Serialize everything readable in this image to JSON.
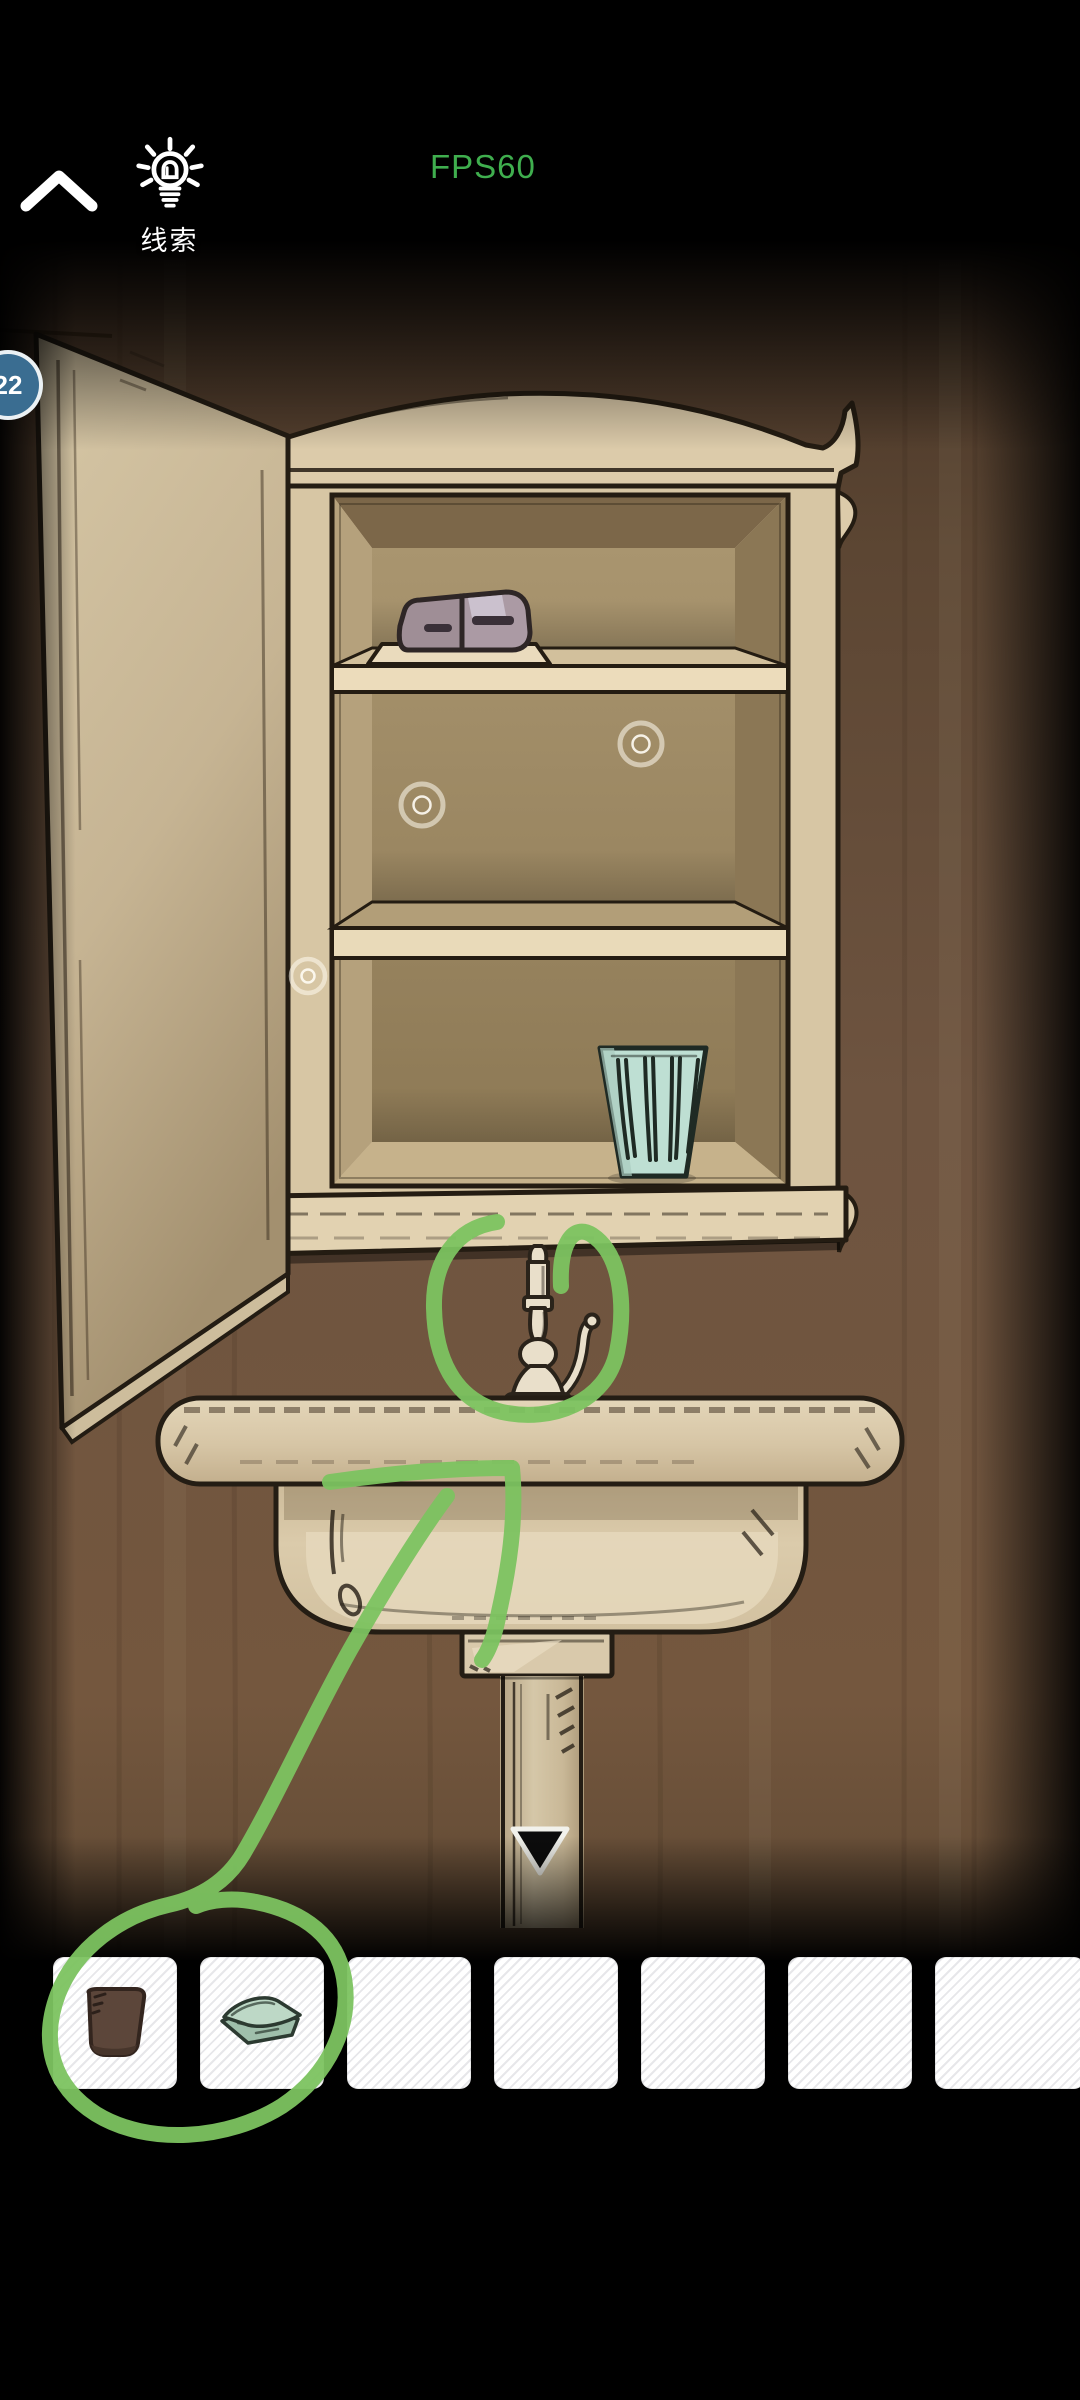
{
  "hud": {
    "hint_label": "线索",
    "fps_label": "FPS60",
    "badge_count": "22",
    "icons": [
      "chevron-up-icon",
      "lightbulb-icon"
    ]
  },
  "theme": {
    "annotation_green": "#7cc360",
    "fps_green": "#3fae4e",
    "badge_blue": "#3a6d91",
    "wood_brown": "#6b5138",
    "cabinet_cream": "#dccbaa",
    "cup_teal": "#bedfd3",
    "item_brown": "#5c463a",
    "towel_green": "#b9d3c2"
  },
  "scene": {
    "objects": [
      "open-cabinet-door",
      "medicine-cabinet",
      "tube-on-tray",
      "teal-cup",
      "faucet",
      "sink-counter",
      "sink-basin",
      "pedestal",
      "down-arrow"
    ],
    "touch_marker_count": 3,
    "hint_annotations": [
      "circle-around-faucet",
      "line-counter-to-drain",
      "line-faucet-to-inventory",
      "circle-around-inventory-items"
    ]
  },
  "inventory": {
    "slot_count": 7,
    "items": [
      {
        "slot": 1,
        "name": "brown-cup"
      },
      {
        "slot": 2,
        "name": "green-towel"
      }
    ]
  }
}
